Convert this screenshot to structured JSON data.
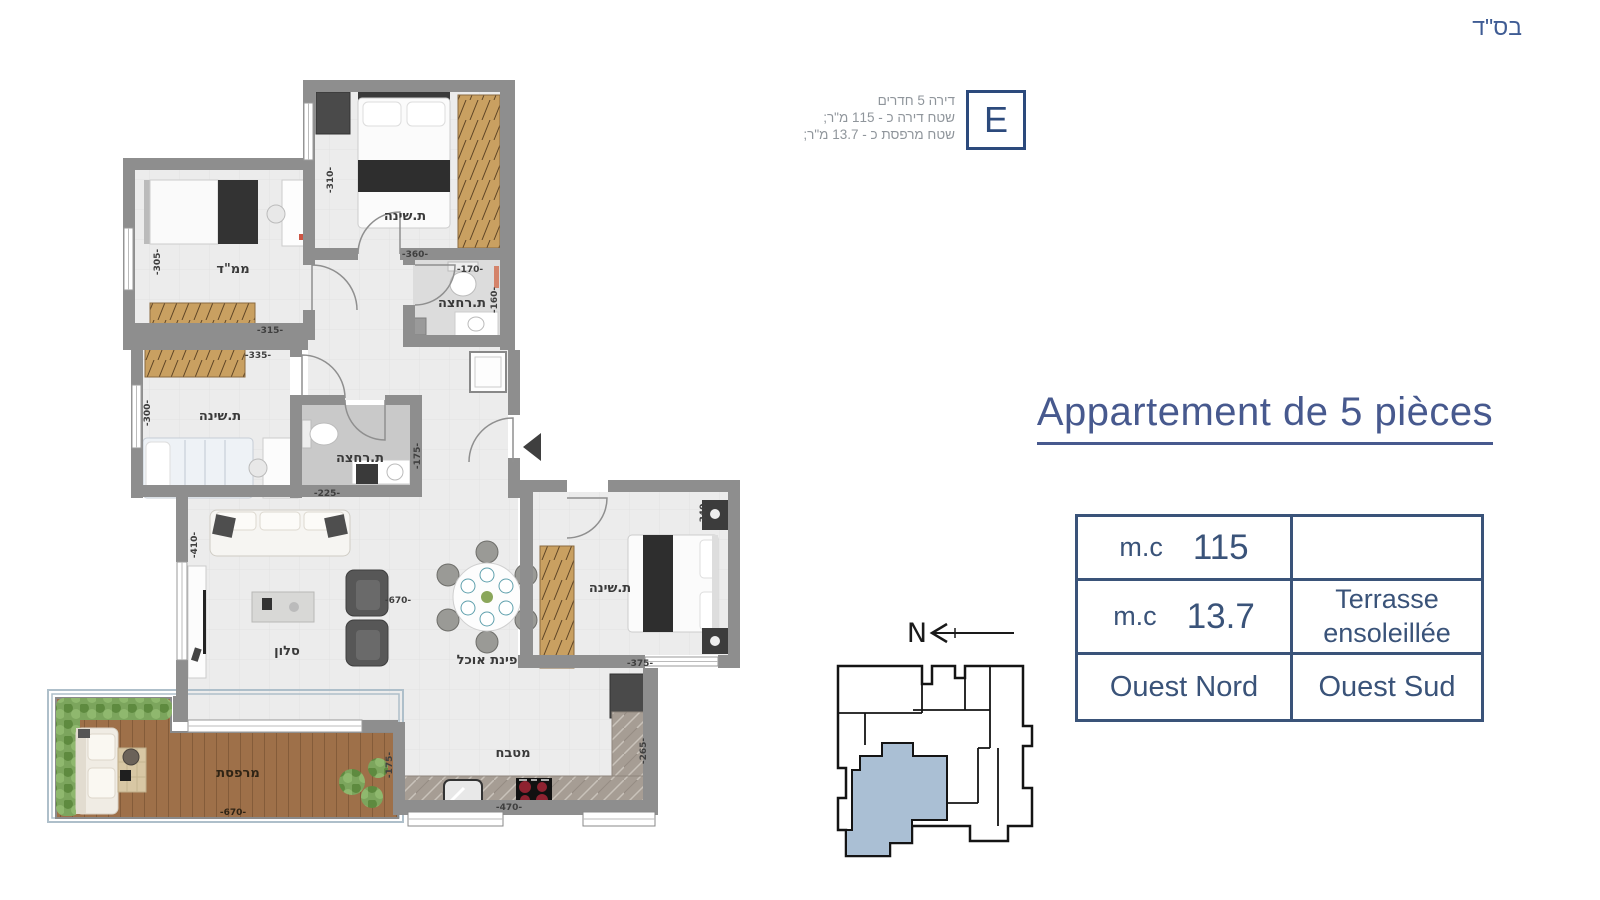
{
  "meta": {
    "bsd": "בס\"ד"
  },
  "unit_info": {
    "letter": "E",
    "lines": [
      "דירה 5 חדרים",
      "שטח דירה כ - 115 מ\"ר;",
      "שטח מרפסת כ - 13.7 מ\"ר;"
    ]
  },
  "title": "Appartement de 5 pièces",
  "spec_table": {
    "rows": [
      {
        "left_unit": "m.c",
        "left_value": "115",
        "right_line1": "",
        "right_line2": ""
      },
      {
        "left_unit": "m.c",
        "left_value": "13.7",
        "right_line1": "Terrasse",
        "right_line2": "ensoleillée"
      },
      {
        "left_text": "Ouest Nord",
        "right_text": "Ouest Sud"
      }
    ]
  },
  "compass": {
    "label": "N"
  },
  "plan": {
    "labels": {
      "bedroom": "ת.שינה",
      "mamad": "ממ\"ד",
      "bathroom": "ת.רחצה",
      "living": "סלון",
      "dining": "פינת אוכל",
      "kitchen": "מטבח",
      "terrace": "מרפסת"
    },
    "dims": {
      "d160": "-160-",
      "d170": "-170-",
      "d175": "-175-",
      "d225": "-225-",
      "d265": "-265-",
      "d300": "-300-",
      "d305": "-305-",
      "d310": "-310-",
      "d315": "-315-",
      "d335": "-335-",
      "d340": "-340-",
      "d360": "-360-",
      "d375": "-375-",
      "d410": "-410-",
      "d470": "-470-",
      "d670": "-670-"
    }
  },
  "colors": {
    "accent_blue": "#3a5379",
    "title_blue": "#47598e",
    "wall_gray": "#8e8e8e",
    "wood": "#c9a061",
    "deck": "#9e7049",
    "unit_highlight": "#aabfd4",
    "hedge": "#7ca55d"
  }
}
